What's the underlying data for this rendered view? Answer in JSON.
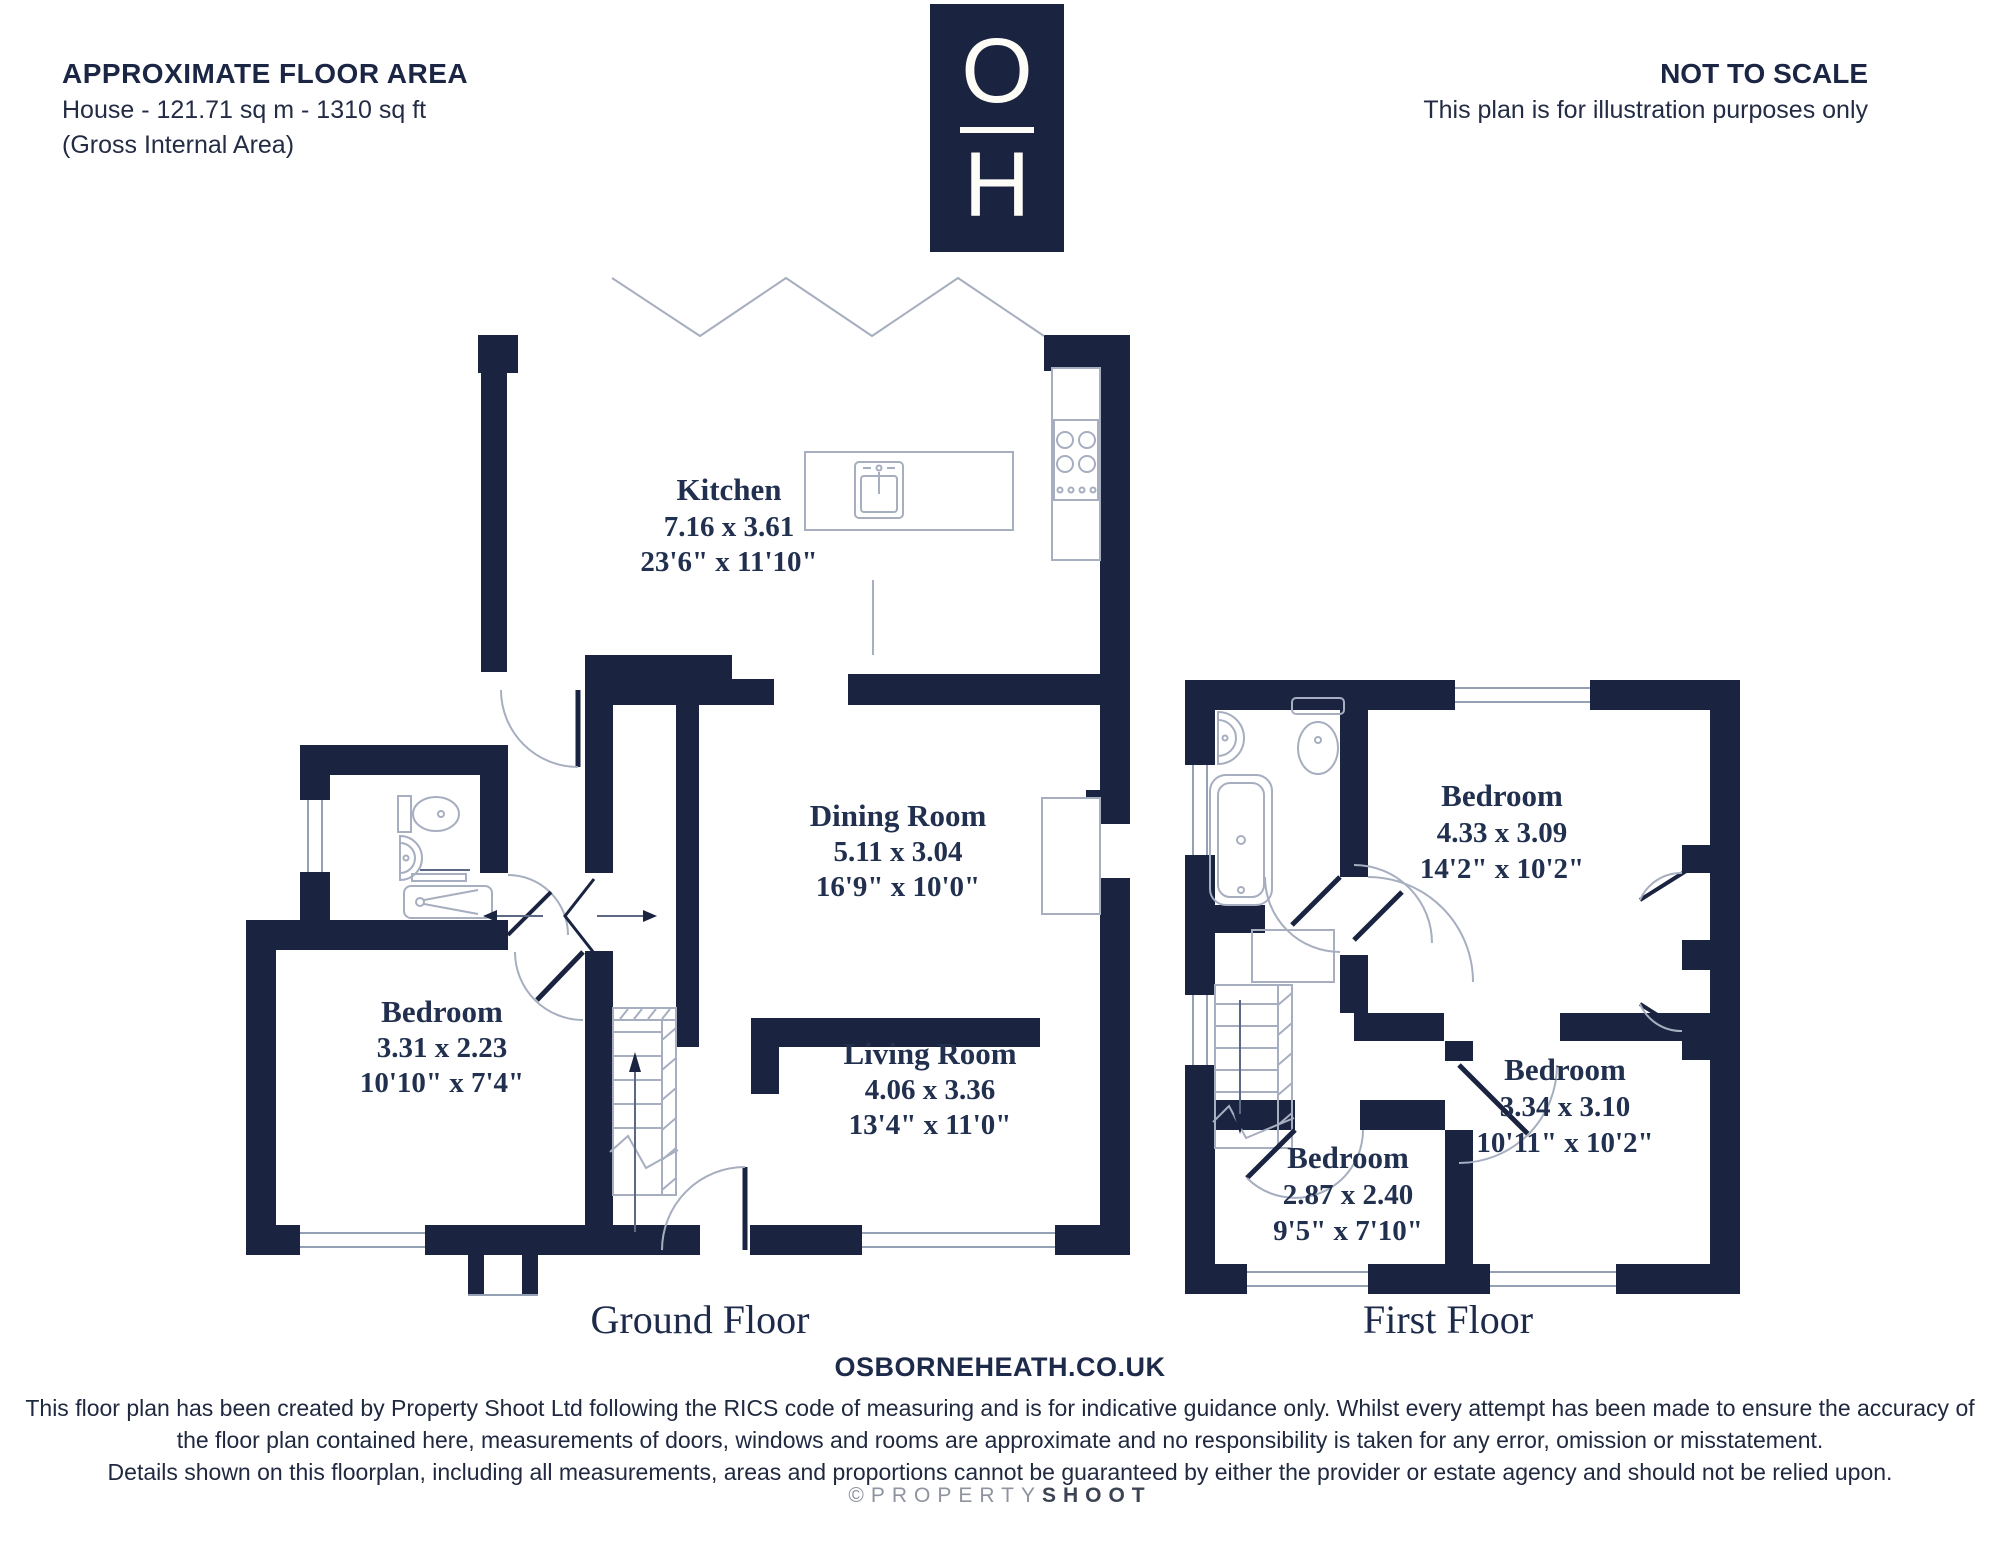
{
  "header": {
    "title": "APPROXIMATE FLOOR AREA",
    "line1": "House - 121.71 sq m - 1310 sq ft",
    "line2": "(Gross Internal Area)"
  },
  "notice": {
    "title": "NOT TO SCALE",
    "subtitle": "This plan is for illustration purposes only"
  },
  "logo": {
    "top_letter": "O",
    "bottom_letter": "H"
  },
  "ground_floor": {
    "caption": "Ground Floor",
    "rooms": [
      {
        "name": "Kitchen",
        "metric": "7.16 x 3.61",
        "imperial": "23'6\" x 11'10\""
      },
      {
        "name": "Dining Room",
        "metric": "5.11 x 3.04",
        "imperial": "16'9\" x 10'0\""
      },
      {
        "name": "Living Room",
        "metric": "4.06 x 3.36",
        "imperial": "13'4\" x 11'0\""
      },
      {
        "name": "Bedroom",
        "metric": "3.31 x 2.23",
        "imperial": "10'10\" x 7'4\""
      }
    ]
  },
  "first_floor": {
    "caption": "First Floor",
    "rooms": [
      {
        "name": "Bedroom",
        "metric": "4.33 x 3.09",
        "imperial": "14'2\" x 10'2\""
      },
      {
        "name": "Bedroom",
        "metric": "3.34 x 3.10",
        "imperial": "10'11\" x 10'2\""
      },
      {
        "name": "Bedroom",
        "metric": "2.87 x 2.40",
        "imperial": "9'5\" x 7'10\""
      }
    ]
  },
  "website": "OSBORNEHEATH.CO.UK",
  "disclaimer": {
    "line1": "This floor plan has been created by Property Shoot Ltd following the RICS code of measuring and is for indicative guidance only. Whilst every attempt has been made to ensure the accuracy of",
    "line2": "the floor plan contained here, measurements of doors, windows and rooms are approximate and no responsibility is taken for any error, omission or misstatement.",
    "line3": "Details shown on this floorplan, including all measurements, areas and proportions cannot be guaranteed by either the provider or estate agency and should not be relied upon."
  },
  "footer": {
    "copyright": "©PROPERTY",
    "brand": "SHOOT"
  },
  "colors": {
    "wall_navy": "#1a2440",
    "label_navy": "#22304f",
    "line_gray": "#a6aebf"
  }
}
